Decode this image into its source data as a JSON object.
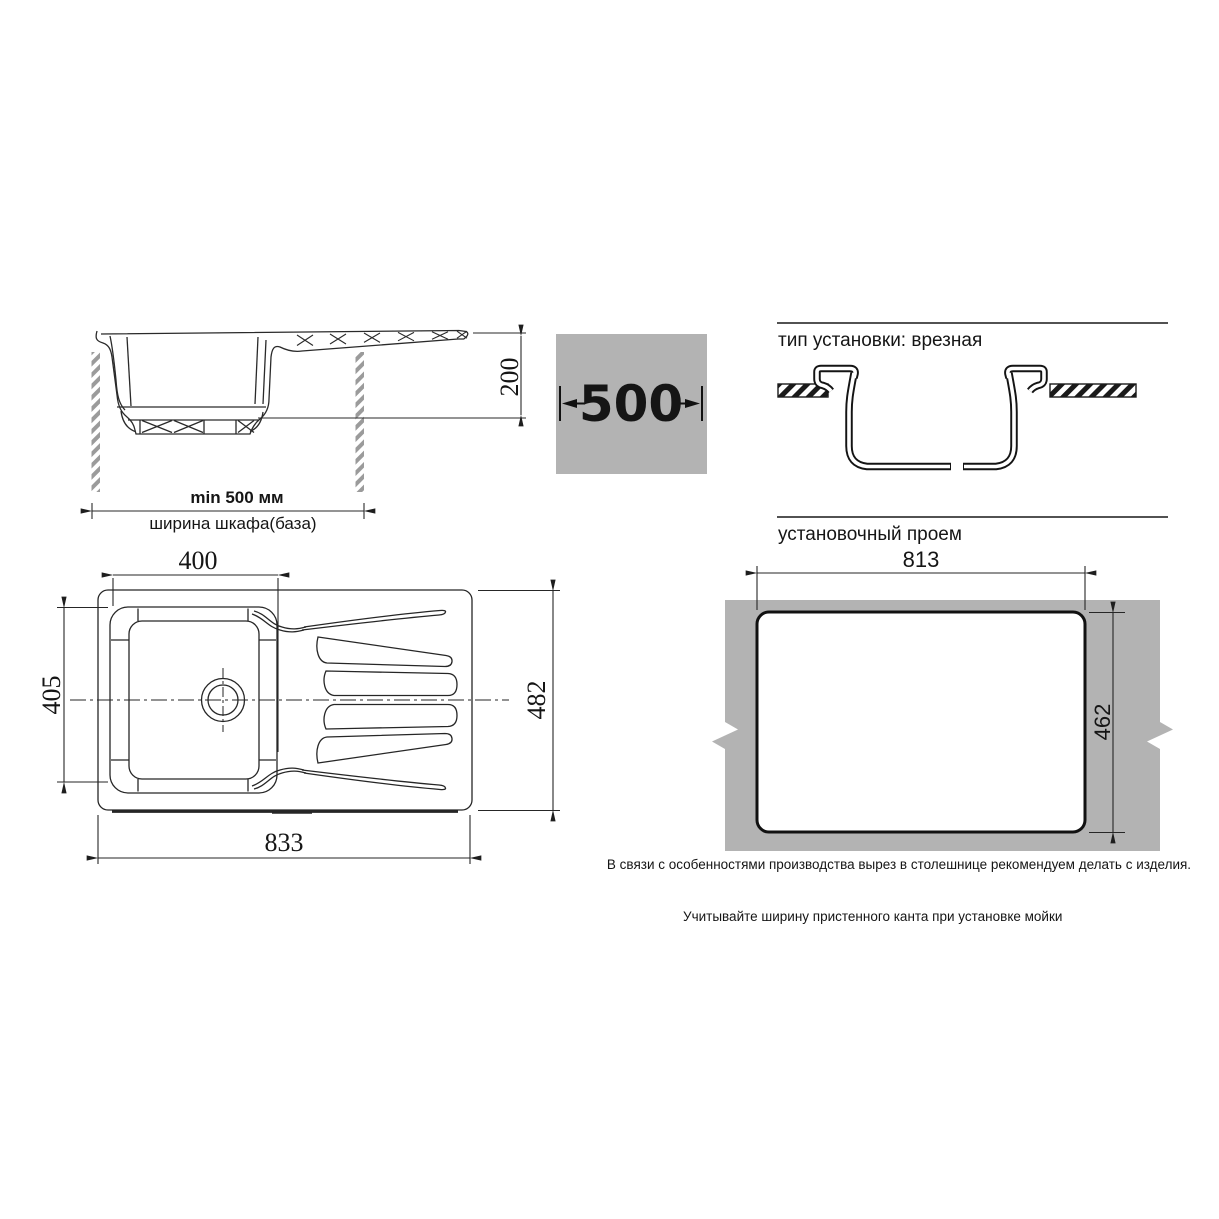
{
  "side_view": {
    "min_width_label": "min 500 мм",
    "cabinet_label": "ширина шкафа(база)",
    "height_dim": "200"
  },
  "width_badge": {
    "value": "500"
  },
  "install_type": {
    "title": "тип установки: врезная"
  },
  "top_view": {
    "bowl_width_dim": "400",
    "bowl_depth_dim": "405",
    "overall_length_dim": "833",
    "overall_width_dim": "482"
  },
  "install_opening": {
    "title": "установочный проем",
    "width_dim": "813",
    "depth_dim": "462",
    "production_note": "В связи с особенностями производства вырез в столешнице рекомендуем делать с изделия.",
    "install_note": "Учитывайте ширину пристенного канта при установке мойки"
  },
  "colors": {
    "gray": "#b3b3b3"
  }
}
